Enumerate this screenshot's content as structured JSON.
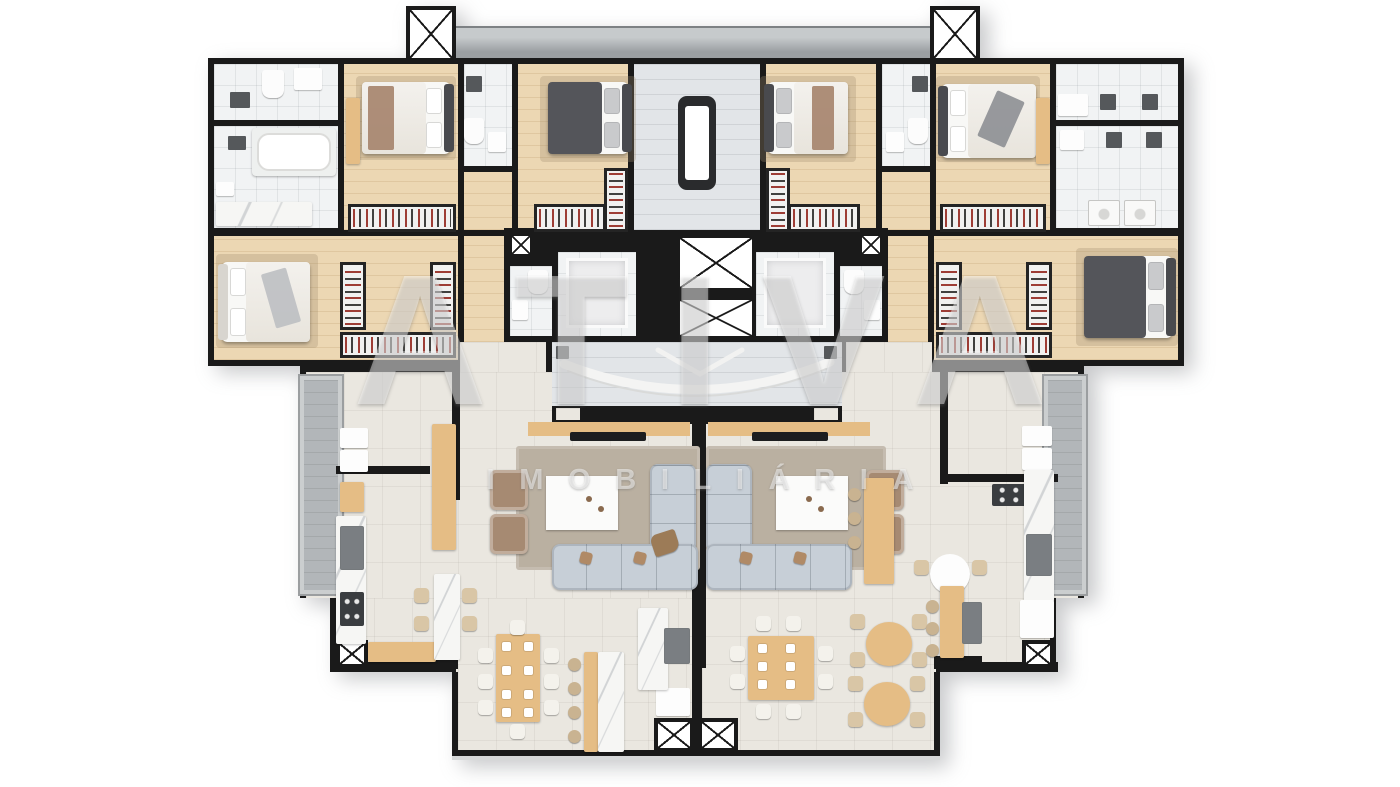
{
  "watermark": {
    "brand": "ATIVA",
    "subtitle": "IMOBILIÁRIA"
  },
  "palette": {
    "background": "#ffffff",
    "wall": "#1a1a1a",
    "wood-floor": "#ecd7b3",
    "wood-furniture": "#e5bd85",
    "tile-white": "#f1f3f4",
    "tile-cream": "#eae7e0",
    "tile-stair": "#e2e5e8",
    "balcony-gray": "#b2b6b9",
    "slab-gray": "#9b9fa2",
    "rug-taupe": "#bab0a1",
    "sofa-gray": "#c7cfd7",
    "armchair-brown": "#a68a72",
    "bed-dark": "#54555a",
    "appliance-gray": "#9b9fa2",
    "window-gray": "#55585b",
    "rack-red": "#9e3d35"
  },
  "floor_plan": {
    "type": "residential-typical-floor-plan",
    "style": "3d-rendered-top-view",
    "symbols": {
      "crossed-square": "elevator-or-utility-shaft",
      "clothes-rack-strip": "wardrobe-with-hanging-clothes",
      "gray-vertical-strip": "balcony",
      "gray-top-band": "roof-slab"
    },
    "core": [
      "stair-hall",
      "elevator-shaft-1",
      "elevator-shaft-2",
      "entry-foyer",
      "service-shafts"
    ],
    "counts": {
      "elevator_shafts": 2,
      "utility_shafts": 8,
      "apartments": 2
    },
    "units": [
      {
        "side": "left",
        "rooms": [
          "suite-bathroom",
          "bedroom-1",
          "bathroom-2",
          "bedroom-2",
          "master-bedroom",
          "walk-in-closet",
          "laundry",
          "kitchen",
          "dining-room",
          "living-room",
          "balcony"
        ]
      },
      {
        "side": "right",
        "rooms": [
          "suite-bathroom",
          "bedroom-1",
          "bathroom-2",
          "bedroom-2",
          "master-bedroom",
          "walk-in-closet",
          "laundry",
          "kitchen",
          "dining-room",
          "living-room",
          "balcony"
        ]
      }
    ]
  }
}
